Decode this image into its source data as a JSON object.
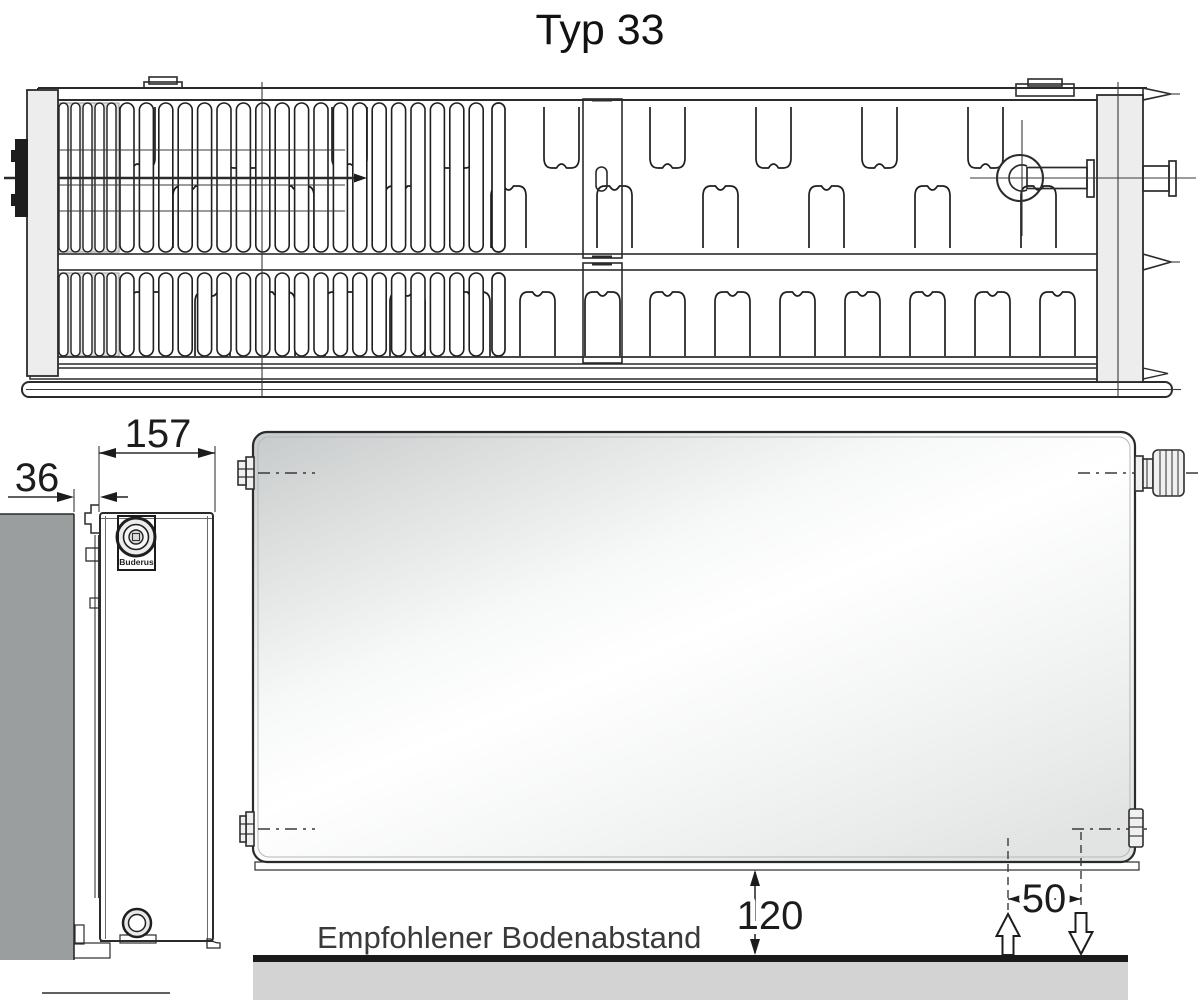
{
  "title": "Typ 33",
  "side_view": {
    "depth_dim": "157",
    "wall_gap_dim": "36",
    "brand": "Buderus"
  },
  "front_view": {
    "floor_clearance_dim": "120",
    "pipe_spacing_dim": "50",
    "floor_note": "Empfohlener Bodenabstand"
  },
  "colors": {
    "line": "#2b2b2b",
    "wall": "#9b9e9e",
    "floor_bar": "#1a1a1a",
    "floor_ground": "#d3d3d3",
    "metal": "#ededed",
    "panel_shade": "#c7caca",
    "panel_highlight": "#ffffff"
  }
}
